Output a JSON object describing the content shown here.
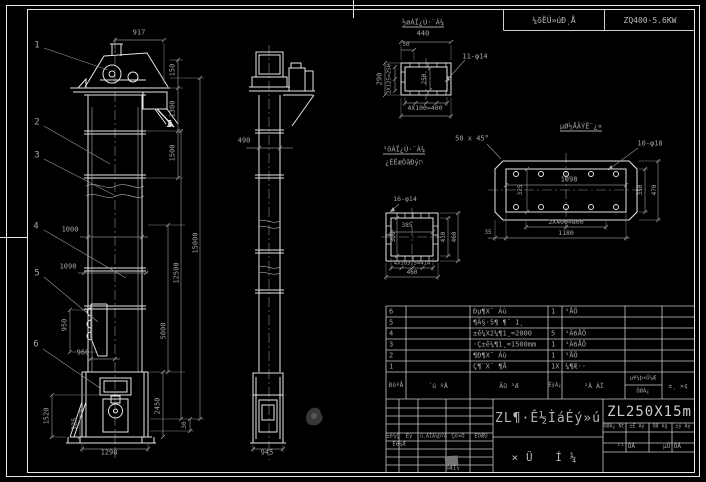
{
  "colors": {
    "background": "#000000",
    "object_lines": "#e6e6e6",
    "dimension_lines": "#878787",
    "text": "#a6a6a6",
    "grid_lines": "#c9c9c9"
  },
  "strip": {
    "left_label": "¼õËÙ»úÐͺÅ",
    "right_label": "ZQ400-5.6KW"
  },
  "title_block": {
    "main_title": "ZL¶·Ê½ÌáÉý»ú",
    "sub_title": "×Ü Í¼",
    "model": "ZL250X15m"
  },
  "bom": {
    "headers": [
      "ÐòºÅ",
      "´ú ºÅ",
      "Ãû ³Æ",
      "ÊýÁ¿",
      "²Ä ÁÏ",
      "µ¥¼þ×Ü¼Æ / ÖØÁ¿",
      "±¸ ×¢"
    ],
    "rows": [
      {
        "no": "6",
        "code": "",
        "name": "Ðµ¶X¯ Áù",
        "qty": "1",
        "material": "¹ÅÖ"
      },
      {
        "no": "5",
        "code": "",
        "name": "¶Ä§·5¶ ¶¨ 1¸",
        "qty": "",
        "material": ""
      },
      {
        "no": "4",
        "code": "",
        "name": "±ê¼X2¼¶1¸=2000",
        "qty": "5",
        "material": "¹Ä6ÅÖ"
      },
      {
        "no": "3",
        "code": "",
        "name": "·Ç±ê¼¶1¸=1500mm",
        "qty": "1",
        "material": "¹Ä6ÅÖ"
      },
      {
        "no": "2",
        "code": "",
        "name": "¶Ð¶X¯ Áù",
        "qty": "1",
        "material": "¹ÅÖ"
      },
      {
        "no": "1",
        "code": "",
        "name": "Ç¶¨X¨ ¶Å",
        "qty": "1X",
        "material": "¼¶Æ··"
      }
    ]
  },
  "annotations": [
    {
      "n": "balloon-1",
      "t": "1",
      "x": 37,
      "y": 46,
      "s": 9
    },
    {
      "n": "balloon-2",
      "t": "2",
      "x": 37,
      "y": 123,
      "s": 9
    },
    {
      "n": "balloon-3",
      "t": "3",
      "x": 37,
      "y": 156,
      "s": 9
    },
    {
      "n": "balloon-4",
      "t": "4",
      "x": 36,
      "y": 227,
      "s": 9
    },
    {
      "n": "balloon-5",
      "t": "5",
      "x": 37,
      "y": 274,
      "s": 9
    },
    {
      "n": "balloon-6",
      "t": "6",
      "x": 36,
      "y": 345,
      "s": 9
    },
    {
      "n": "dim-917",
      "t": "917",
      "x": 139,
      "y": 33
    },
    {
      "n": "dim-150",
      "t": "150",
      "x": 173,
      "y": 70,
      "r": 1
    },
    {
      "n": "dim-1300",
      "t": "1300",
      "x": 173,
      "y": 109,
      "r": 1
    },
    {
      "n": "dim-1500",
      "t": "1500",
      "x": 173,
      "y": 153,
      "r": 1
    },
    {
      "n": "dim-15000",
      "t": "15000",
      "x": 196,
      "y": 243,
      "r": 1
    },
    {
      "n": "dim-12500",
      "t": "12500",
      "x": 177,
      "y": 273,
      "r": 1
    },
    {
      "n": "dim-5000",
      "t": "5000",
      "x": 164,
      "y": 331,
      "r": 1
    },
    {
      "n": "dim-2450",
      "t": "2450",
      "x": 158,
      "y": 406,
      "r": 1
    },
    {
      "n": "dim-30",
      "t": "30",
      "x": 185,
      "y": 425,
      "r": 1,
      "s": 6
    },
    {
      "n": "dim-1000",
      "t": "1000",
      "x": 70,
      "y": 230
    },
    {
      "n": "dim-1090",
      "t": "1090",
      "x": 68,
      "y": 267
    },
    {
      "n": "dim-950",
      "t": "950",
      "x": 65,
      "y": 325,
      "r": 1
    },
    {
      "n": "dim-960",
      "t": "960",
      "x": 83,
      "y": 353
    },
    {
      "n": "dim-1520",
      "t": "1520",
      "x": 47,
      "y": 416,
      "r": 1
    },
    {
      "n": "dim-325",
      "t": "325",
      "x": 75,
      "y": 424,
      "r": 1
    },
    {
      "n": "dim-1298",
      "t": "1298",
      "x": 109,
      "y": 453
    },
    {
      "n": "section-mark-I",
      "t": "I",
      "x": 169,
      "y": 125,
      "s": 10,
      "b": 1,
      "c": "#e0e0e0"
    },
    {
      "n": "dim-490",
      "t": "490",
      "x": 244,
      "y": 141
    },
    {
      "n": "dim-945",
      "t": "945",
      "x": 267,
      "y": 453
    },
    {
      "n": "label-top-flange",
      "t": "½øÁÏ¿Ú·¨À¼",
      "x": 423,
      "y": 23,
      "u": 1
    },
    {
      "n": "dim-440",
      "t": "440",
      "x": 423,
      "y": 34
    },
    {
      "n": "dim-50",
      "t": "50",
      "x": 406,
      "y": 45,
      "s": 6
    },
    {
      "n": "dim-290",
      "t": "290",
      "x": 380,
      "y": 79,
      "r": 1
    },
    {
      "n": "dim-2x125",
      "t": "2X125=250",
      "x": 390,
      "y": 79,
      "r": 1,
      "s": 5.5
    },
    {
      "n": "dim-250",
      "t": "250",
      "x": 425,
      "y": 79,
      "r": 1,
      "s": 6
    },
    {
      "n": "callout-11-phi14",
      "t": "11-φ14",
      "x": 475,
      "y": 57
    },
    {
      "n": "dim-4x100",
      "t": "4X100=400",
      "x": 425,
      "y": 108,
      "s": 6.5
    },
    {
      "n": "label-square-flange",
      "t": "³öÁÏ¿Ú·¨À¼",
      "x": 404,
      "y": 150,
      "u": 1
    },
    {
      "n": "label-square-note",
      "t": "¿ÉËæÒâÐýת",
      "x": 404,
      "y": 163
    },
    {
      "n": "callout-16-phi14",
      "t": "16-φ14",
      "x": 405,
      "y": 199,
      "s": 6.5
    },
    {
      "n": "dim-385",
      "t": "385",
      "x": 407,
      "y": 226,
      "s": 6
    },
    {
      "n": "dim-300",
      "t": "300",
      "x": 394,
      "y": 237,
      "r": 1,
      "s": 6
    },
    {
      "n": "dim-410",
      "t": "410",
      "x": 444,
      "y": 237,
      "r": 1,
      "s": 6
    },
    {
      "n": "dim-460-right",
      "t": "460",
      "x": 455,
      "y": 237,
      "r": 1,
      "s": 6
    },
    {
      "n": "dim-4x103",
      "t": "4X103.5=414",
      "x": 412,
      "y": 264,
      "s": 5.5
    },
    {
      "n": "dim-460-bottom",
      "t": "460",
      "x": 412,
      "y": 273,
      "s": 6
    },
    {
      "n": "label-anchor-plan",
      "t": "µØ½ÅÂÝË¨¿×",
      "x": 581,
      "y": 127,
      "u": 1
    },
    {
      "n": "note-chamfer",
      "t": "50 x 45°",
      "x": 472,
      "y": 139
    },
    {
      "n": "callout-10-phi18",
      "t": "10-φ18",
      "x": 650,
      "y": 144
    },
    {
      "n": "dim-1098",
      "t": "1098",
      "x": 569,
      "y": 180
    },
    {
      "n": "dim-325-plan",
      "t": "325",
      "x": 521,
      "y": 190,
      "r": 1,
      "s": 6
    },
    {
      "n": "dim-350",
      "t": "350",
      "x": 641,
      "y": 190,
      "r": 1,
      "s": 6
    },
    {
      "n": "dim-470",
      "t": "470",
      "x": 655,
      "y": 190,
      "r": 1,
      "s": 6
    },
    {
      "n": "dim-2x400",
      "t": "2X400=800",
      "x": 566,
      "y": 222,
      "s": 6.5
    },
    {
      "n": "dim-1180",
      "t": "1180",
      "x": 566,
      "y": 233,
      "s": 6.5
    },
    {
      "n": "dim-35",
      "t": "35",
      "x": 488,
      "y": 233,
      "s": 6
    },
    {
      "n": "bom-header-no",
      "t": "ÐòºÅ",
      "x": 396,
      "y": 386,
      "s": 6
    },
    {
      "n": "bom-header-code",
      "t": "´ú ºÅ",
      "x": 438,
      "y": 386,
      "s": 6.5
    },
    {
      "n": "bom-header-name",
      "t": "Ãû ³Æ",
      "x": 509,
      "y": 386,
      "s": 6.5
    },
    {
      "n": "bom-header-qty",
      "t": "ÊýÁ¿",
      "x": 555,
      "y": 386,
      "s": 5.5
    },
    {
      "n": "bom-header-material",
      "t": "²Ä ÁÏ",
      "x": 594,
      "y": 386,
      "s": 6.5
    },
    {
      "n": "bom-header-unit-weight",
      "t": "µ¥¼þ×Ü¼Æ",
      "x": 643,
      "y": 379,
      "s": 5.5
    },
    {
      "n": "bom-header-weight",
      "t": "ÖØÁ¿",
      "x": 643,
      "y": 392,
      "s": 5.5
    },
    {
      "n": "bom-header-remark",
      "t": "±¸ ×¢",
      "x": 678,
      "y": 386,
      "s": 6.5
    },
    {
      "n": "tb-header-mark",
      "t": "±ê¼Ç",
      "x": 393,
      "y": 437,
      "s": 5.5
    },
    {
      "n": "tb-header-count",
      "t": "Êý",
      "x": 409,
      "y": 437,
      "s": 5.5
    },
    {
      "n": "tb-header-docno",
      "t": "¸ü¸ÄÎÄ¼þºÅ",
      "x": 432,
      "y": 437,
      "s": 5
    },
    {
      "n": "tb-header-sign",
      "t": "Ç©×Ö",
      "x": 458,
      "y": 437,
      "s": 5.5
    },
    {
      "n": "tb-header-date",
      "t": "ÈÕÆÚ",
      "x": 481,
      "y": 437,
      "s": 5.5
    },
    {
      "n": "tb-design",
      "t": "Éè¼Æ",
      "x": 399,
      "y": 445,
      "s": 5.5
    },
    {
      "n": "tb-draw",
      "t": "ÖÆÍ¼",
      "x": 453,
      "y": 469,
      "s": 5.5
    },
    {
      "n": "tb-weight-label",
      "t": "ÖØÁ¿ Nt",
      "x": 614,
      "y": 427,
      "s": 5
    },
    {
      "n": "tb-scale-label",
      "t": "±È Àý",
      "x": 637,
      "y": 427,
      "s": 5
    },
    {
      "n": "tb-weight-kg",
      "t": "ÖØ kg",
      "x": 660,
      "y": 427,
      "s": 5
    },
    {
      "n": "tb-scale-2",
      "t": "±ý Àý",
      "x": 683,
      "y": 427,
      "s": 5
    },
    {
      "n": "tb-sheet-total",
      "t": "¹² ÕÅ",
      "x": 626,
      "y": 447,
      "s": 6
    },
    {
      "n": "tb-sheet-no",
      "t": "µÚ ÕÅ",
      "x": 672,
      "y": 447,
      "s": 6
    }
  ]
}
